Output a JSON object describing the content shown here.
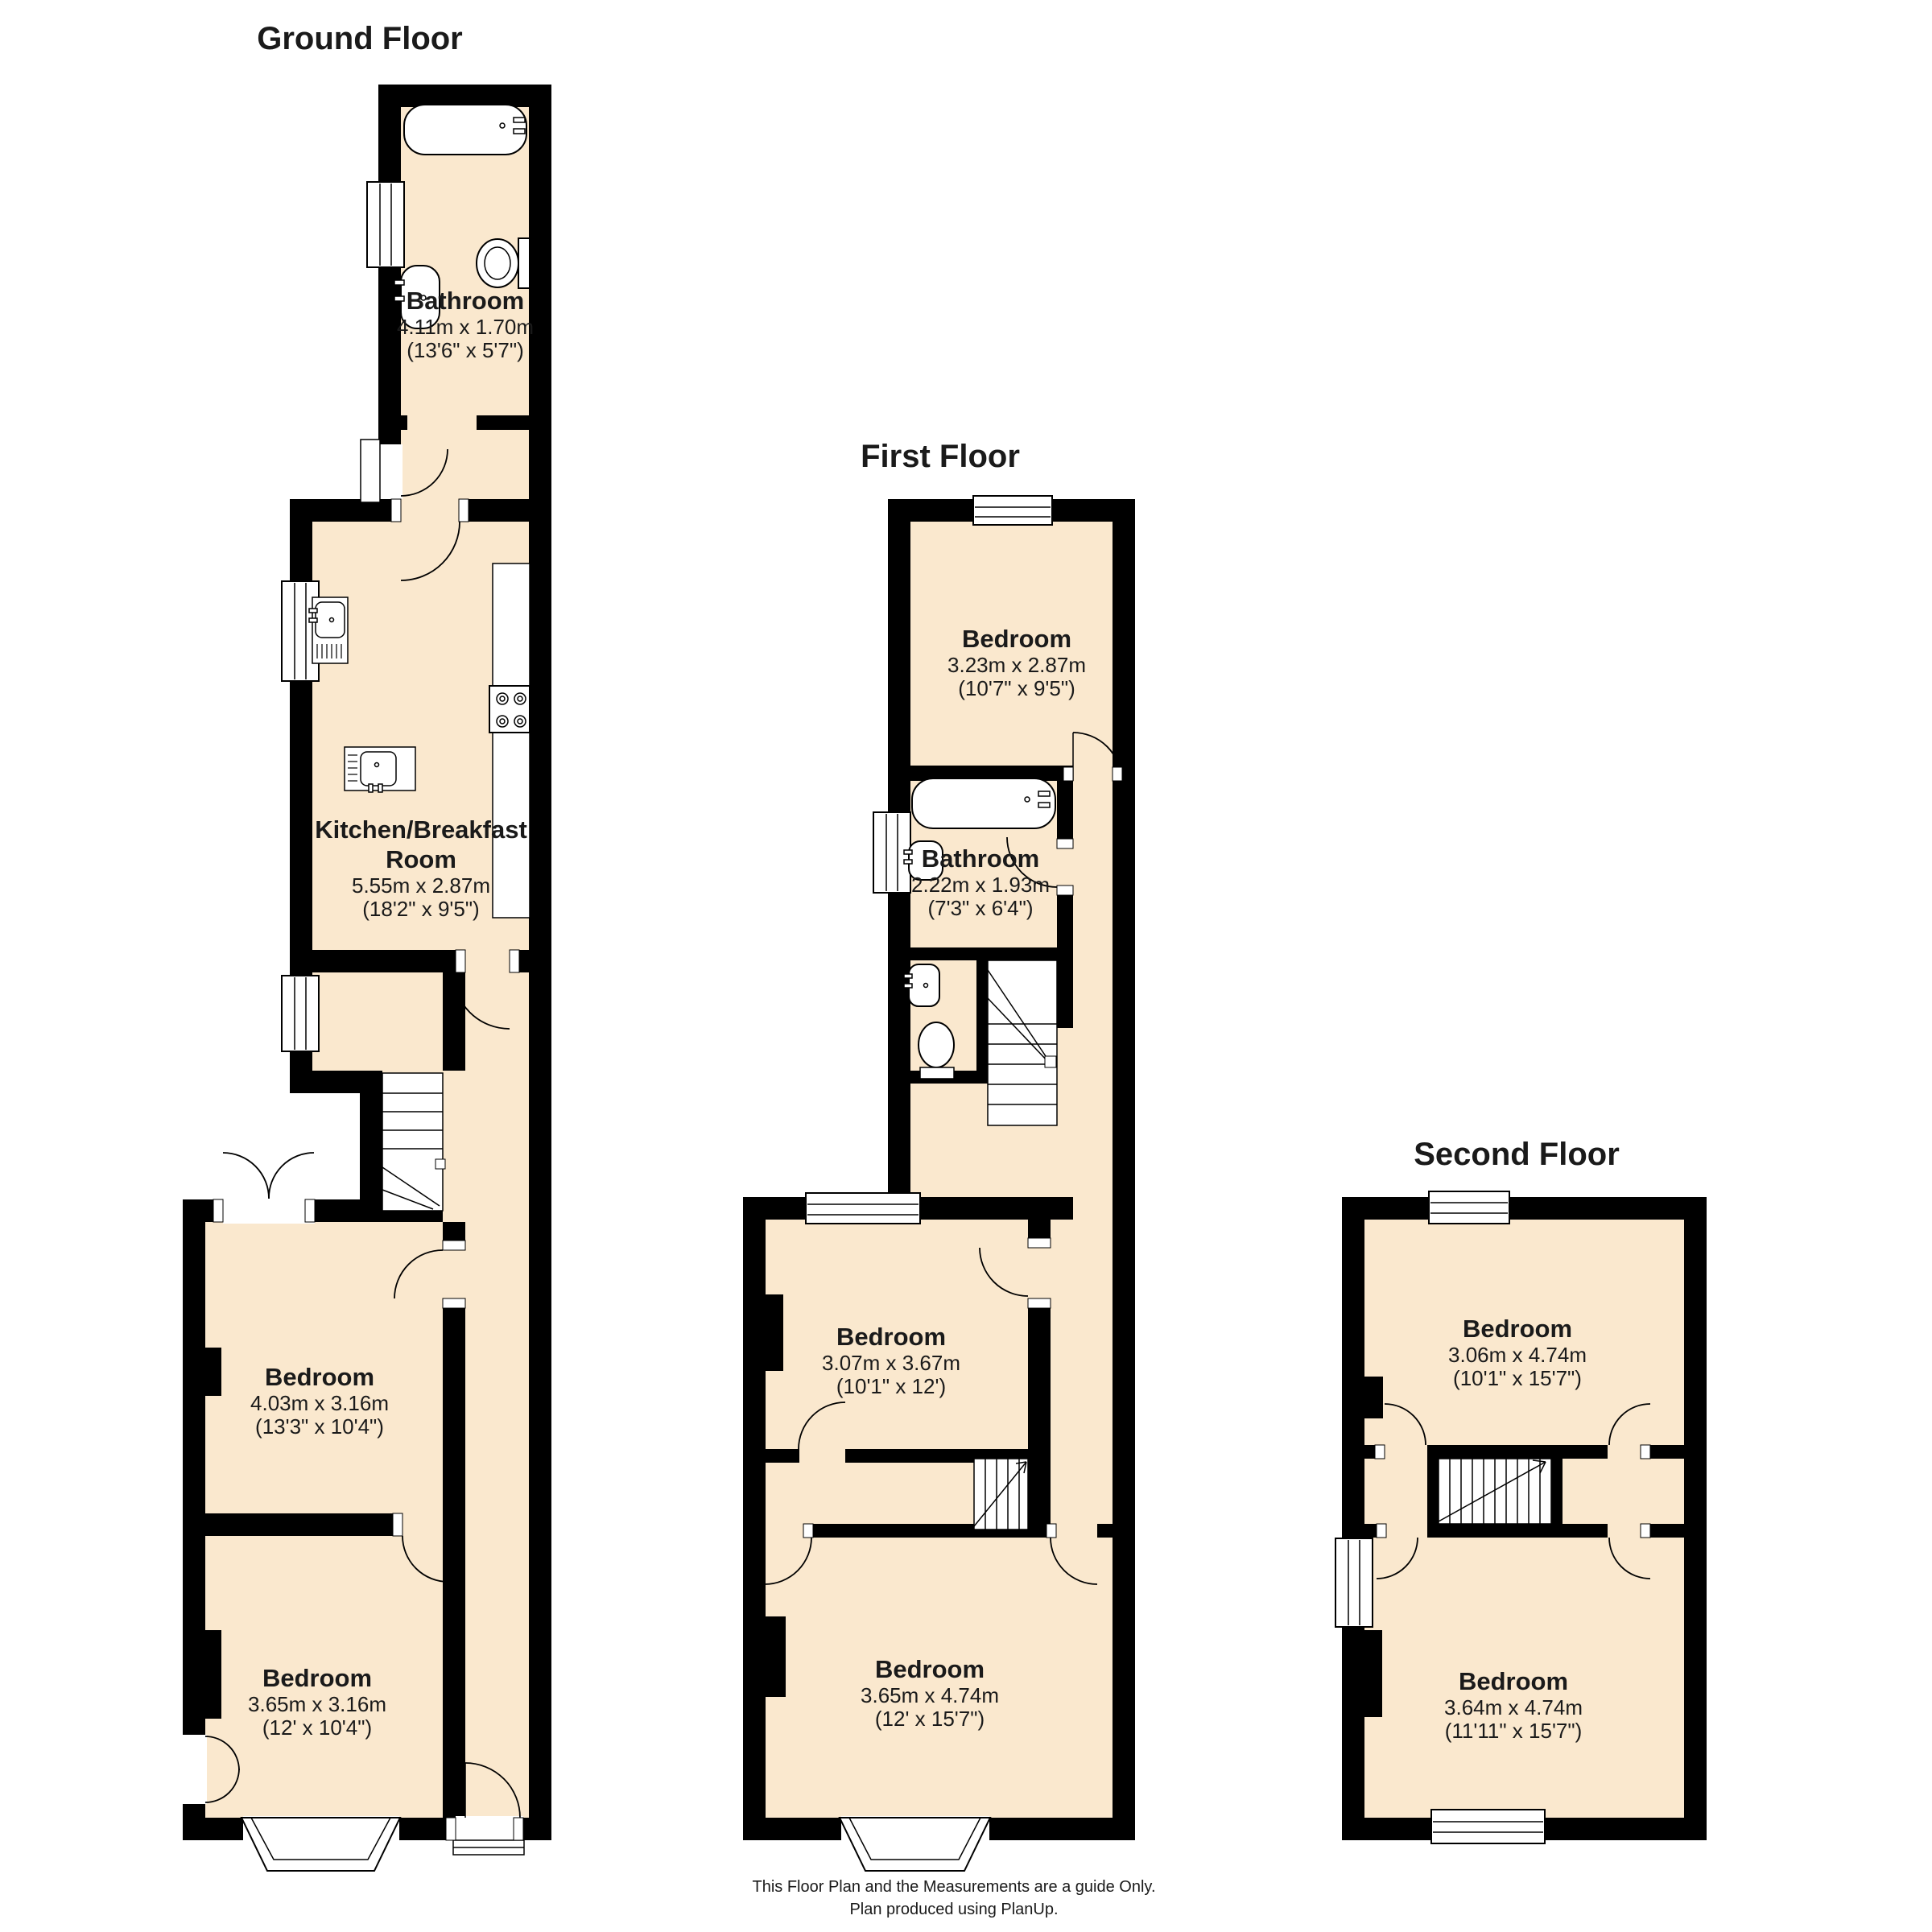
{
  "colors": {
    "room_fill": "#FAE8CE",
    "wall": "#000000",
    "background": "#ffffff"
  },
  "footer": {
    "line1": "This Floor Plan and the Measurements are a guide Only.",
    "line2": "Plan produced using PlanUp."
  },
  "floors": [
    {
      "id": "ground",
      "title": "Ground Floor",
      "rooms": [
        {
          "name": "Bathroom",
          "metric": "4.11m x 1.70m",
          "imperial": "(13'6\" x 5'7\")"
        },
        {
          "name": "Kitchen/Breakfast Room",
          "metric": "5.55m x 2.87m",
          "imperial": "(18'2\" x 9'5\")"
        },
        {
          "name": "Bedroom",
          "metric": "4.03m x 3.16m",
          "imperial": "(13'3\" x 10'4\")"
        },
        {
          "name": "Bedroom",
          "metric": "3.65m x 3.16m",
          "imperial": "(12' x 10'4\")"
        }
      ]
    },
    {
      "id": "first",
      "title": "First Floor",
      "rooms": [
        {
          "name": "Bedroom",
          "metric": "3.23m x 2.87m",
          "imperial": "(10'7\" x 9'5\")"
        },
        {
          "name": "Bathroom",
          "metric": "2.22m x 1.93m",
          "imperial": "(7'3\" x 6'4\")"
        },
        {
          "name": "Bedroom",
          "metric": "3.07m x 3.67m",
          "imperial": "(10'1\" x 12')"
        },
        {
          "name": "Bedroom",
          "metric": "3.65m x 4.74m",
          "imperial": "(12' x 15'7\")"
        }
      ]
    },
    {
      "id": "second",
      "title": "Second Floor",
      "rooms": [
        {
          "name": "Bedroom",
          "metric": "3.06m x 4.74m",
          "imperial": "(10'1\" x 15'7\")"
        },
        {
          "name": "Bedroom",
          "metric": "3.64m x 4.74m",
          "imperial": "(11'11\" x 15'7\")"
        }
      ]
    }
  ]
}
